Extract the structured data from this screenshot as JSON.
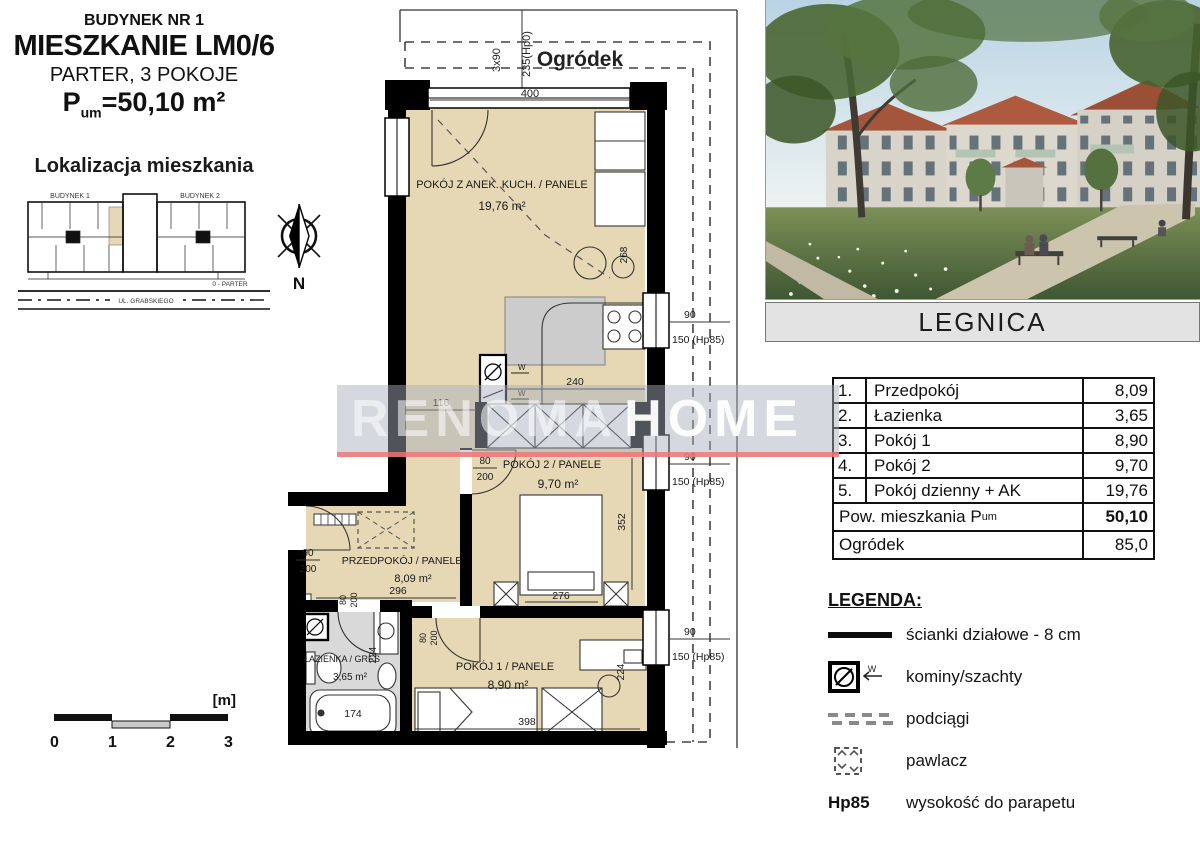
{
  "header": {
    "building": "BUDYNEK NR 1",
    "apartment": "MIESZKANIE LM0/6",
    "floor": "PARTER, 3 POKOJE",
    "area_p": "P",
    "area_sub": "um",
    "area_rest": "=50,10 m²"
  },
  "location": {
    "title": "Lokalizacja mieszkania",
    "b1": "BUDYNEK 1",
    "b2": "BUDYNEK 2",
    "parter": "0 - PARTER",
    "street": "UL. GRABSKIEGO",
    "north": "N"
  },
  "plan": {
    "garden": "Ogródek",
    "living_name": "POKÓJ Z ANEK. KUCH. / PANELE",
    "living_area": "19,76 m²",
    "room2_name": "POKÓJ 2 / PANELE",
    "room2_area": "9,70 m²",
    "hall_name": "PRZEDPOKÓJ / PANELE",
    "hall_area": "8,09 m²",
    "room1_name": "POKÓJ 1 / PANELE",
    "room1_area": "8,90 m²",
    "bath_name": "ŁAZIENKA / GRES",
    "bath_area": "3,65 m²",
    "dims": {
      "d400": "400",
      "d3x90": "3x90",
      "d235": "235(Hp0)",
      "d268": "268",
      "d240": "240",
      "d116": "116",
      "d80": "80",
      "d200": "200",
      "d90": "90",
      "d352": "352",
      "d276": "276",
      "d296": "296",
      "d224": "224",
      "d174": "174",
      "d398": "398",
      "w90": "90",
      "w150": "150 (Hp85)",
      "vent": "W",
      "lt1": "LT1"
    }
  },
  "watermark": {
    "left": "RENOMA",
    "right": "HOME"
  },
  "photo": {
    "caption": "LEGNICA"
  },
  "table": {
    "rows": [
      {
        "no": "1.",
        "name": "Przedpokój",
        "value": "8,09"
      },
      {
        "no": "2.",
        "name": "Łazienka",
        "value": "3,65"
      },
      {
        "no": "3.",
        "name": "Pokój 1",
        "value": "8,90"
      },
      {
        "no": "4.",
        "name": "Pokój 2",
        "value": "9,70"
      },
      {
        "no": "5.",
        "name": "Pokój dzienny + AK",
        "value": "19,76"
      }
    ],
    "total_label": "Pow. mieszkania P",
    "total_sub": "um",
    "total_value": "50,10",
    "garden_label": "Ogródek",
    "garden_value": "85,0"
  },
  "legend": {
    "title": "LEGENDA:",
    "walls": "ścianki działowe - 8 cm",
    "chimneys": "kominy/szachty",
    "beams": "podciągi",
    "pawlacz": "pawlacz",
    "hp_code": "Hp85",
    "hp_text": "wysokość do parapetu",
    "w": "W"
  },
  "scalebar": {
    "unit": "[m]",
    "t0": "0",
    "t1": "1",
    "t2": "2",
    "t3": "3"
  }
}
